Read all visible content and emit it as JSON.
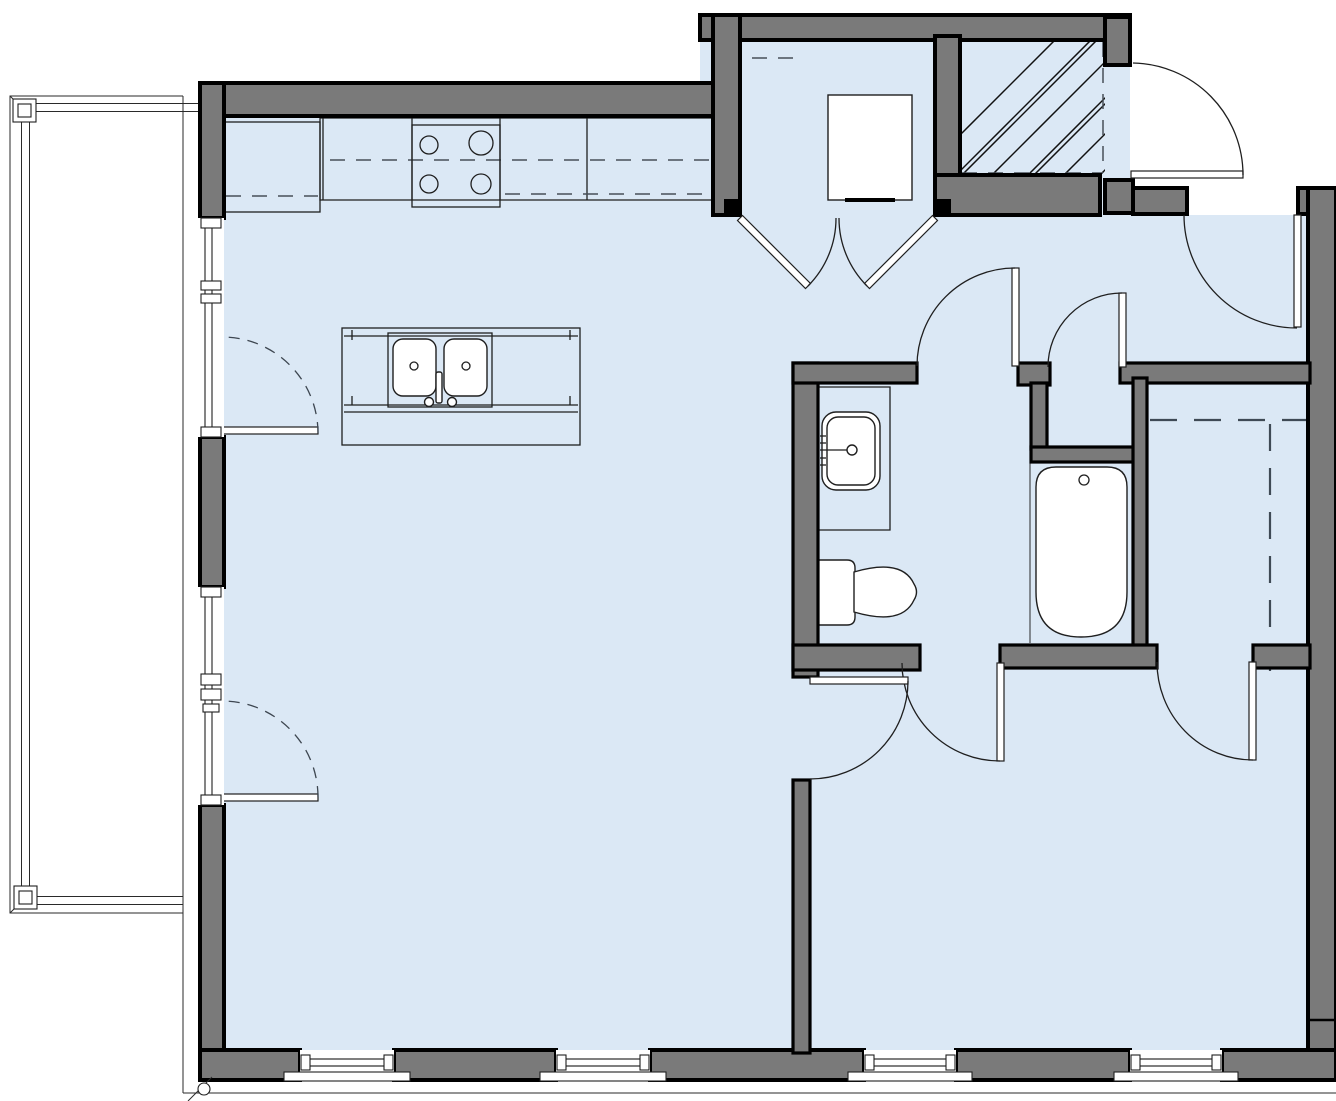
{
  "drawing": {
    "type": "architectural-floor-plan",
    "visible_text": [],
    "units_labeled": false
  },
  "colors": {
    "floor_fill": "#dbe8f5",
    "wall_fill": "#7a7a7a",
    "wall_edge": "#000000",
    "linework": "#1f1f1f",
    "exterior_background": "#ffffff",
    "dashed_lines": "#3f4a55",
    "fixture_fill": "#ffffff"
  },
  "elements": {
    "balcony": {
      "railing_posts": 2,
      "sides_with_railing": 3
    },
    "kitchen": {
      "counter_run_sections": 4,
      "refrigerator_box": 1,
      "range_burners": 4,
      "island": {
        "sink_bowls": 2,
        "faucet": 1
      }
    },
    "utility_closet": {
      "appliance_square": 1,
      "door_type": "double-swing",
      "shelf_dash": 1
    },
    "shaft": {
      "fill_pattern": "diagonal-hatch",
      "dashed_edges": 2,
      "corridor_door": 1
    },
    "bathroom": {
      "fixtures": [
        "vanity-sink",
        "toilet",
        "bathtub"
      ],
      "doors": 2,
      "linen_closet_door": 1
    },
    "walk_in_closet": {
      "dashed_rod_lines": 2,
      "door": 1
    },
    "bedroom": {
      "entry_door": 1,
      "closet_door": 1
    },
    "windows": {
      "bottom_wall": 4,
      "left_wall_glazed_panels": 2
    },
    "balcony_doors_dashed_swing": 2,
    "site_marks": {
      "corner_column_circle": 1,
      "ground_line": 1
    }
  }
}
